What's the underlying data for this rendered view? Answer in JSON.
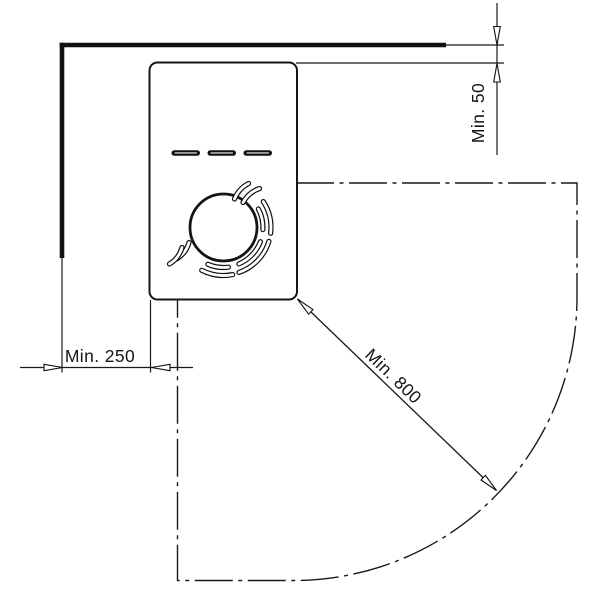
{
  "background_color": "#ffffff",
  "line_color": "#1a1a1a",
  "labels": {
    "top_clearance": "Min. 50",
    "side_clearance": "Min. 250",
    "radius_clearance": "Min. 800"
  }
}
